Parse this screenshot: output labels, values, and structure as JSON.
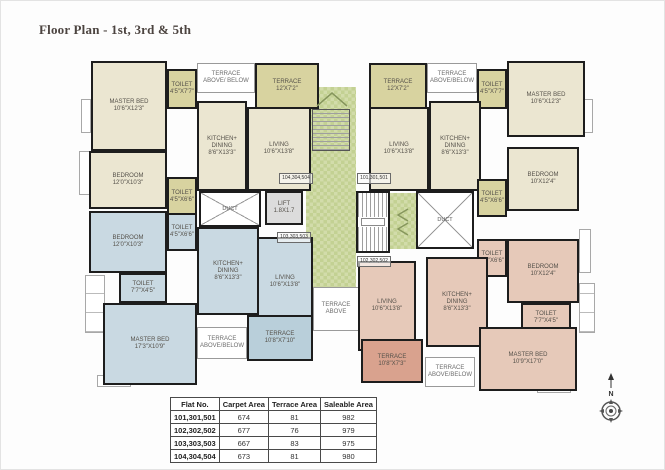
{
  "title": "Floor Plan - 1st, 3rd & 5th",
  "plan": {
    "flats": {
      "top_left": {
        "badge": "104,304,504",
        "master_bed": {
          "lines": [
            "MASTER BED",
            "10'6\"X12'3\""
          ]
        },
        "toilet_top": {
          "lines": [
            "TOILET",
            "4'5\"X7'7\""
          ]
        },
        "bedroom": {
          "lines": [
            "BEDROOM",
            "12'0\"X10'3\""
          ]
        },
        "toilet_bottom": {
          "lines": [
            "TOILET",
            "4'5\"X6'6\""
          ]
        },
        "kitchen": {
          "lines": [
            "KITCHEN+",
            "DINING",
            "8'6\"X13'3\""
          ]
        },
        "living": {
          "lines": [
            "LIVING",
            "10'6\"X13'8\""
          ]
        },
        "terrace": {
          "lines": [
            "TERRACE",
            "12'X7'2\""
          ]
        },
        "terrace_ab": {
          "lines": [
            "TERRACE",
            "ABOVE/ BELOW"
          ]
        }
      },
      "top_right": {
        "badge": "101,301,501",
        "master_bed": {
          "lines": [
            "MASTER BED",
            "10'6\"X12'3\""
          ]
        },
        "toilet_top": {
          "lines": [
            "TOILET",
            "4'5\"X7'7\""
          ]
        },
        "bedroom": {
          "lines": [
            "BEDROOM",
            "10'X12'4\""
          ]
        },
        "toilet_bottom": {
          "lines": [
            "TOILET",
            "4'5\"X6'6\""
          ]
        },
        "kitchen": {
          "lines": [
            "KITCHEN+",
            "DINING",
            "8'6\"X13'3\""
          ]
        },
        "living": {
          "lines": [
            "LIVING",
            "10'6\"X13'8\""
          ]
        },
        "terrace": {
          "lines": [
            "TERRACE",
            "12'X7'2\""
          ]
        },
        "terrace_ab": {
          "lines": [
            "TERRACE",
            "ABOVE/BELOW"
          ]
        }
      },
      "bottom_left": {
        "badge": "103,303,503",
        "bedroom": {
          "lines": [
            "BEDROOM",
            "12'0\"X10'3\""
          ]
        },
        "toilet_top": {
          "lines": [
            "TOILET",
            "4'5\"X6'6\""
          ]
        },
        "kitchen": {
          "lines": [
            "KITCHEN+",
            "DINING",
            "8'6\"X13'3\""
          ]
        },
        "living": {
          "lines": [
            "LIVING",
            "10'6\"X13'8\""
          ]
        },
        "toilet_mid": {
          "lines": [
            "TOILET",
            "7'7\"X4'5\""
          ]
        },
        "master_bed": {
          "lines": [
            "MASTER BED",
            "17'3\"X10'9\""
          ]
        },
        "terrace": {
          "lines": [
            "TERRACE",
            "10'8\"X7'10\""
          ]
        },
        "terrace_ab": {
          "lines": [
            "TERRACE",
            "ABOVE/BELOW"
          ]
        }
      },
      "bottom_right": {
        "badge": "102,302,502",
        "toilet_top": {
          "lines": [
            "TOILET",
            "4'5\"X6'6\""
          ]
        },
        "bedroom": {
          "lines": [
            "BEDROOM",
            "10'X12'4\""
          ]
        },
        "living": {
          "lines": [
            "LIVING",
            "10'6\"X13'8\""
          ]
        },
        "kitchen": {
          "lines": [
            "KITCHEN+",
            "DINING",
            "8'6\"X13'3\""
          ]
        },
        "toilet_mid": {
          "lines": [
            "TOILET",
            "7'7\"X4'5\""
          ]
        },
        "master_bed": {
          "lines": [
            "MASTER BED",
            "10'9\"X17'0\""
          ]
        },
        "terrace": {
          "lines": [
            "TERRACE",
            "10'8\"X7'3\""
          ]
        },
        "terrace_ab": {
          "lines": [
            "TERRACE",
            "ABOVE/BELOW"
          ]
        }
      }
    },
    "core": {
      "lift": {
        "lines": [
          "LIFT",
          "1.8X1.7"
        ]
      },
      "duct_left": "DUCT",
      "duct_right": "DUCT",
      "terrace_above": {
        "lines": [
          "TERRACE",
          "ABOVE"
        ]
      }
    },
    "compass_label": "N"
  },
  "table": {
    "headers": [
      "Flat No.",
      "Carpet Area",
      "Terrace Area",
      "Saleable Area"
    ],
    "rows": [
      [
        "101,301,501",
        "674",
        "81",
        "982"
      ],
      [
        "102,302,502",
        "677",
        "76",
        "979"
      ],
      [
        "103,303,503",
        "667",
        "83",
        "975"
      ],
      [
        "104,304,504",
        "673",
        "81",
        "980"
      ]
    ]
  },
  "colors": {
    "cream_flat": "#ebe6d1",
    "olive_terrace": "#d8d3a0",
    "blue_flat": "#c9d9e2",
    "pink_flat": "#e6c9b9",
    "lobby_green": "#d2dcaa",
    "wall": "#1d1d1d"
  }
}
